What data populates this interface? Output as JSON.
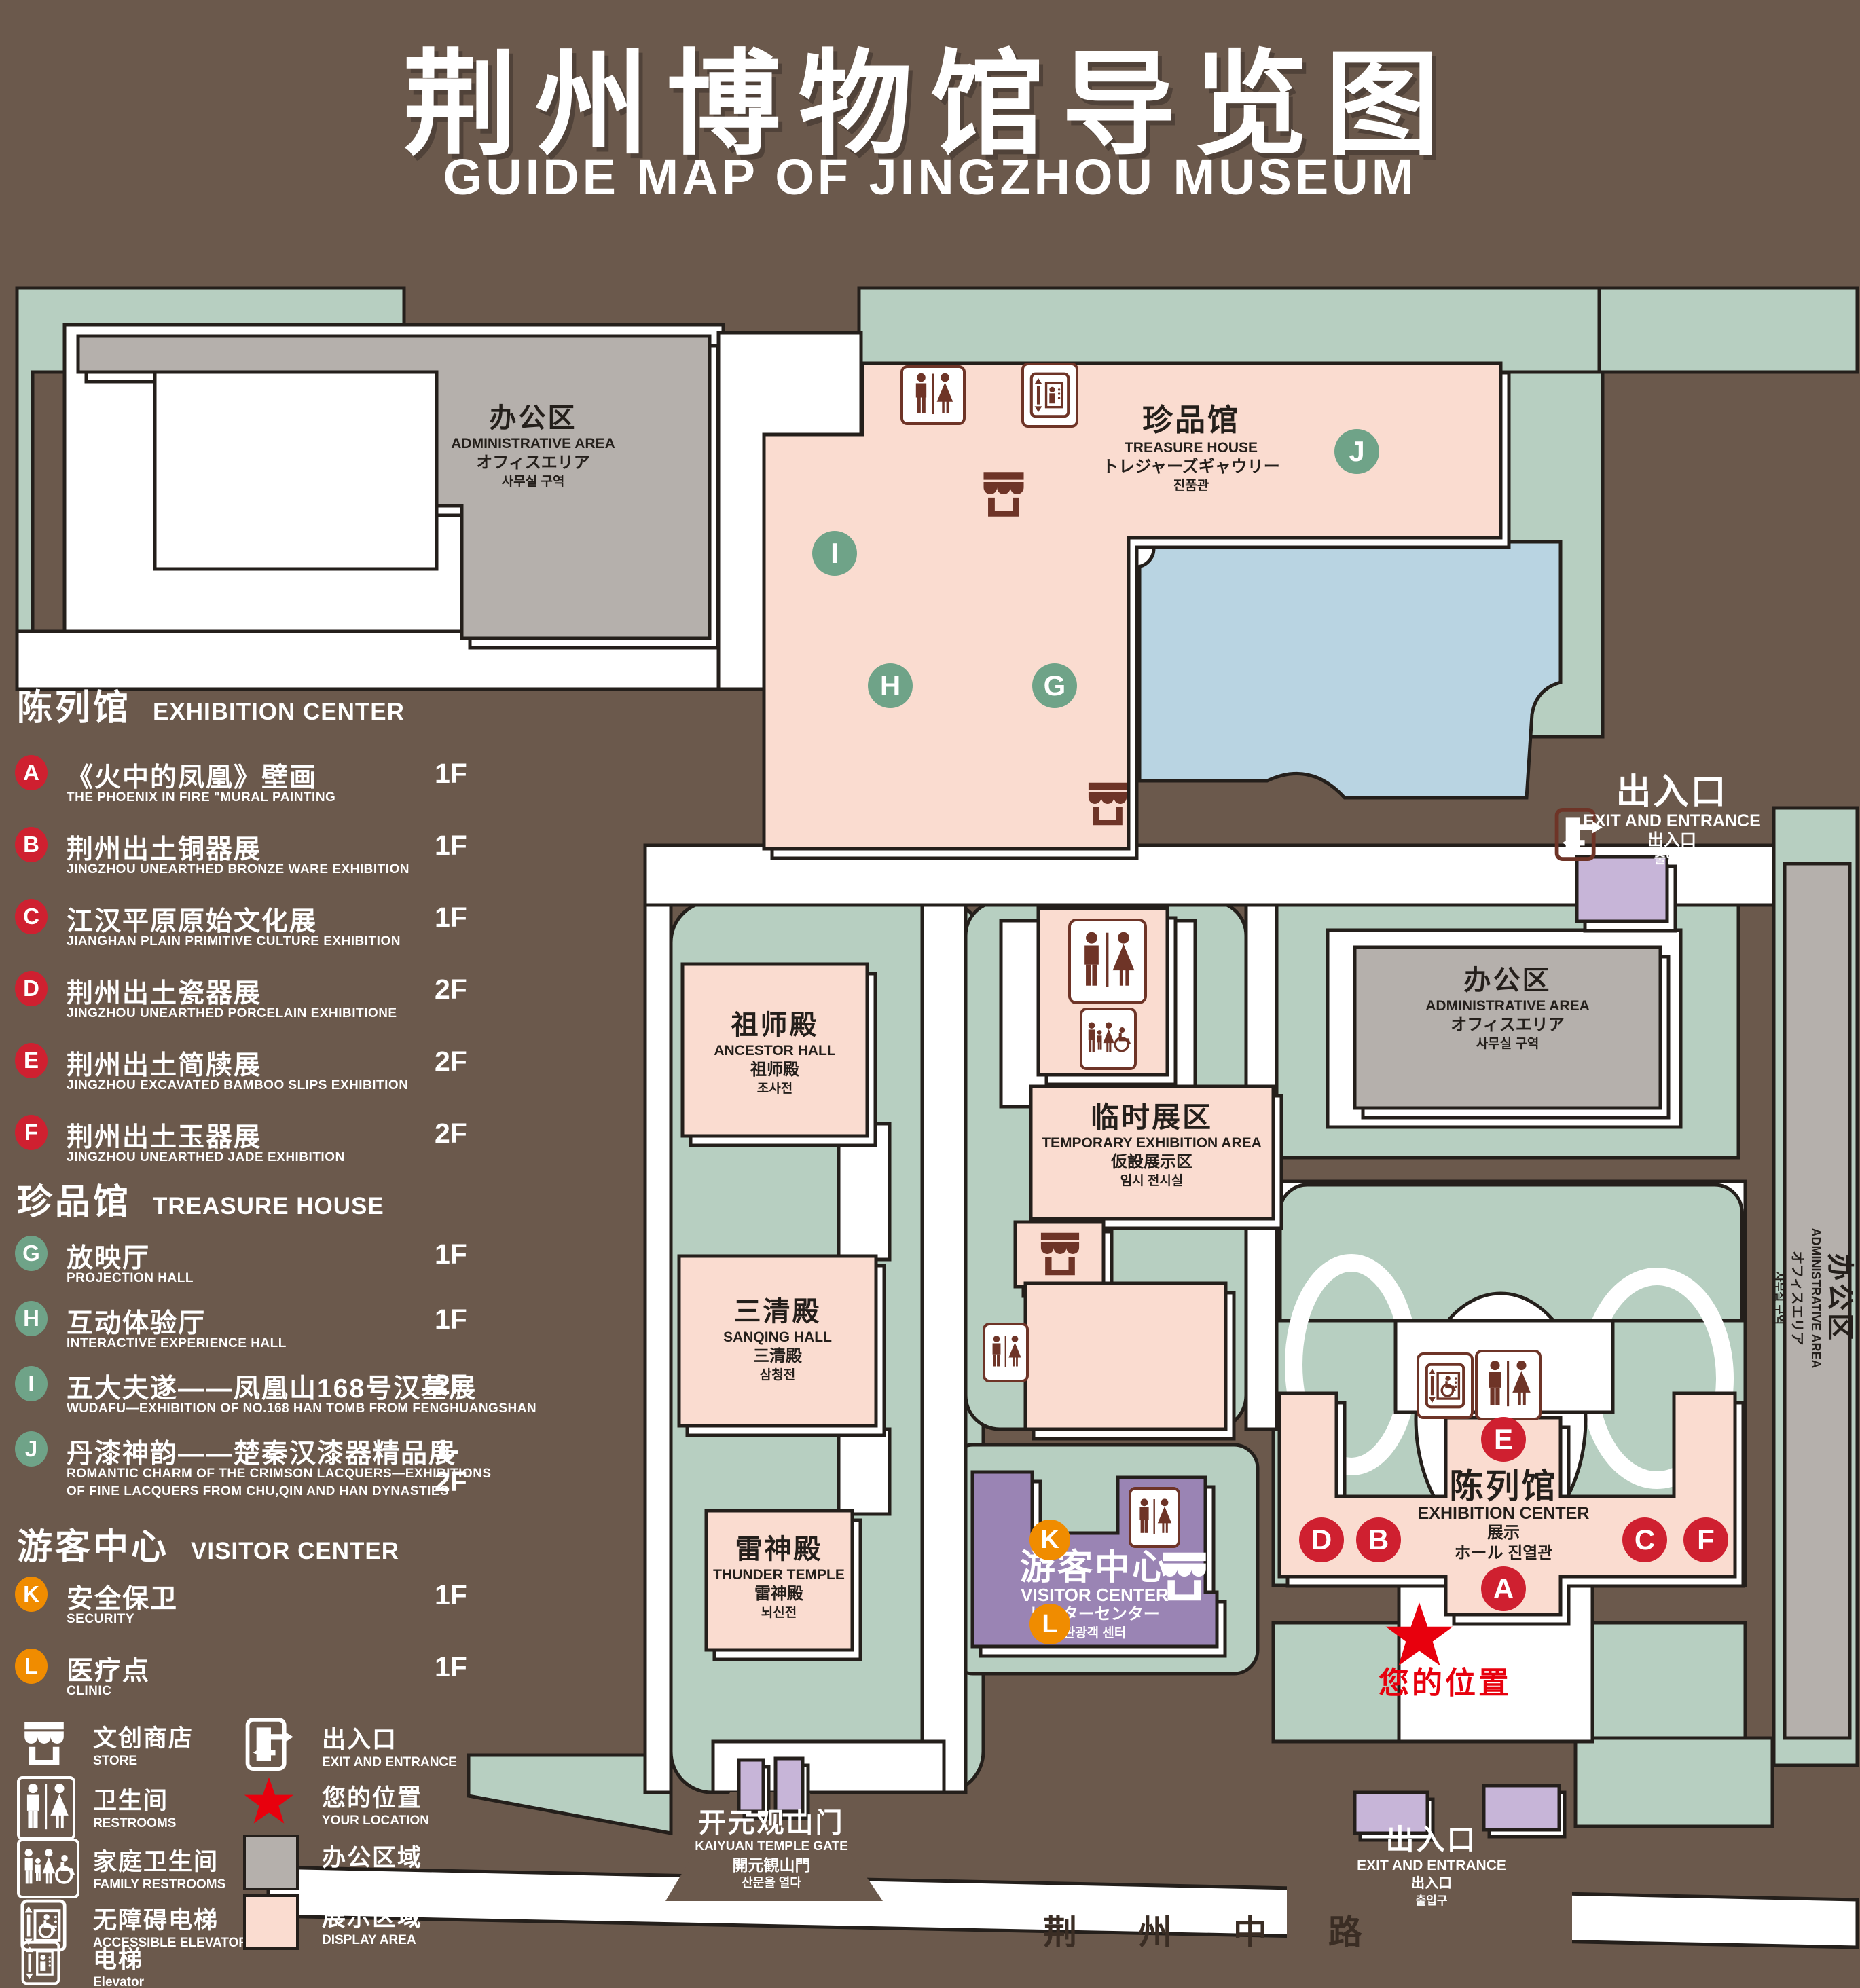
{
  "page": {
    "title_zh": "荆州博物馆导览图",
    "title_en": "GUIDE MAP OF JINGZHOU MUSEUM"
  },
  "colors": {
    "background": "#6B594C",
    "lawn_green": "#B7CFC1",
    "display_area_pink": "#FADCD0",
    "office_area_gray": "#B5B0AC",
    "pond_blue": "#B9D4E2",
    "visitor_center_purple": "#9A84B4",
    "light_purple": "#C7B5D8",
    "badge_red": "#CF2030",
    "badge_green": "#6FA388",
    "badge_orange": "#F08C00",
    "icon_brown": "#6E3427",
    "star_red": "#E8000D"
  },
  "legend": {
    "sections": [
      {
        "zh": "陈列馆",
        "en": "EXHIBITION CENTER",
        "items": [
          {
            "letter": "A",
            "zh": "《火中的凤凰》壁画",
            "en": "THE PHOENIX IN FIRE \"MURAL PAINTING",
            "floor": "1F"
          },
          {
            "letter": "B",
            "zh": "荆州出土铜器展",
            "en": "JINGZHOU UNEARTHED BRONZE WARE EXHIBITION",
            "floor": "1F"
          },
          {
            "letter": "C",
            "zh": "江汉平原原始文化展",
            "en": "JIANGHAN PLAIN PRIMITIVE CULTURE EXHIBITION",
            "floor": "1F"
          },
          {
            "letter": "D",
            "zh": "荆州出土瓷器展",
            "en": "JINGZHOU UNEARTHED PORCELAIN EXHIBITIONE",
            "floor": "2F"
          },
          {
            "letter": "E",
            "zh": "荆州出土简牍展",
            "en": "JINGZHOU EXCAVATED BAMBOO SLIPS EXHIBITION",
            "floor": "2F"
          },
          {
            "letter": "F",
            "zh": "荆州出土玉器展",
            "en": "JINGZHOU UNEARTHED JADE EXHIBITION",
            "floor": "2F"
          }
        ]
      },
      {
        "zh": "珍品馆",
        "en": "TREASURE HOUSE",
        "items": [
          {
            "letter": "G",
            "zh": "放映厅",
            "en": "PROJECTION HALL",
            "floor": "1F"
          },
          {
            "letter": "H",
            "zh": "互动体验厅",
            "en": "INTERACTIVE EXPERIENCE HALL",
            "floor": "1F"
          },
          {
            "letter": "I",
            "zh": "五大夫遂——凤凰山168号汉墓展",
            "en": "WUDAFU—EXHIBITION OF NO.168 HAN TOMB FROM FENGHUANGSHAN",
            "floor": "2F"
          },
          {
            "letter": "J",
            "zh": "丹漆神韵——楚秦汉漆器精品展",
            "en": "ROMANTIC CHARM OF THE CRIMSON LACQUERS—EXHIBITIONS",
            "en2": "OF FINE LACQUERS FROM CHU,QIN AND HAN DYNASTIES",
            "floor": "1-2F"
          }
        ]
      },
      {
        "zh": "游客中心",
        "en": "VISITOR CENTER",
        "items": [
          {
            "letter": "K",
            "zh": "安全保卫",
            "en": "SECURITY",
            "floor": "1F"
          },
          {
            "letter": "L",
            "zh": "医疗点",
            "en": "CLINIC",
            "floor": "1F"
          }
        ]
      }
    ],
    "icon_items": [
      {
        "icon": "store-icon",
        "zh": "文创商店",
        "en": "STORE"
      },
      {
        "icon": "restrooms-icon",
        "zh": "卫生间",
        "en": "RESTROOMS"
      },
      {
        "icon": "family-restrooms-icon",
        "zh": "家庭卫生间",
        "en": "FAMILY RESTROOMS"
      },
      {
        "icon": "accessible-elevator-icon",
        "zh": "无障碍电梯",
        "en": "ACCESSIBLE ELEVATOR"
      },
      {
        "icon": "elevator-icon",
        "zh": "电梯",
        "en": "Elevator"
      },
      {
        "icon": "exit-icon",
        "zh": "出入口",
        "en": "EXIT AND ENTRANCE"
      },
      {
        "icon": "your-location-icon",
        "zh": "您的位置",
        "en": "YOUR LOCATION"
      },
      {
        "icon": "office-area-swatch",
        "zh": "办公区域",
        "en": "OFFICE AREA"
      },
      {
        "icon": "display-area-swatch",
        "zh": "展示区域",
        "en": "DISPLAY AREA"
      }
    ]
  },
  "map": {
    "buildings": {
      "admin_top_left": {
        "zh": "办公区",
        "en": "ADMINISTRATIVE AREA",
        "ja": "オフィスエリア",
        "ko": "사무실 구역"
      },
      "treasure_house": {
        "zh": "珍品馆",
        "en": "TREASURE HOUSE",
        "ja": "トレジャーズギャウリー",
        "ko": "진품관"
      },
      "admin_right": {
        "zh": "办公区",
        "en": "ADMINISTRATIVE AREA",
        "ja": "オフィスエリア",
        "ko": "사무실 구역"
      },
      "admin_strip": {
        "zh": "办公区",
        "en": "ADMINISTRATIVE AREA",
        "ja": "オフィスエリア",
        "ko": "사무실 구역"
      },
      "ancestor_hall": {
        "zh": "祖师殿",
        "en": "ANCESTOR HALL",
        "ja": "祖师殿",
        "ko": "조사전"
      },
      "temporary": {
        "zh": "临时展区",
        "en": "TEMPORARY EXHIBITION AREA",
        "ja": "仮設展示区",
        "ko": "임시 전시실"
      },
      "sanqing_hall": {
        "zh": "三清殿",
        "en": "SANQING HALL",
        "ja": "三清殿",
        "ko": "삼청전"
      },
      "thunder_temple": {
        "zh": "雷神殿",
        "en": "THUNDER TEMPLE",
        "ja": "雷神殿",
        "ko": "뇌신전"
      },
      "visitor_center": {
        "zh": "游客中心",
        "en": "VISITOR CENTER",
        "ja": "ビジターセンター",
        "ko": "관광객 센터"
      },
      "exhibition_center": {
        "zh": "陈列馆",
        "en": "EXHIBITION CENTER",
        "ja": "展示",
        "ja2": "ホール 진열관"
      },
      "gate": {
        "zh": "开元观山门",
        "en": "KAIYUAN TEMPLE GATE",
        "ja": "開元観山門",
        "ko": "산문을 열다"
      },
      "exit_top": {
        "zh": "出入口",
        "en": "EXIT AND ENTRANCE",
        "ja": "出入口",
        "ko": "출입구"
      },
      "exit_bottom": {
        "zh": "出入口",
        "en": "EXIT AND ENTRANCE",
        "ja": "出入口",
        "ko": "출입구"
      },
      "your_location": {
        "zh": "您的位置"
      },
      "road": {
        "zh": "荆 州 中 路"
      }
    },
    "markers": {
      "a": "A",
      "b": "B",
      "c": "C",
      "d": "D",
      "e": "E",
      "f": "F",
      "g": "G",
      "h": "H",
      "i": "I",
      "j": "J",
      "k": "K",
      "l": "L"
    }
  }
}
